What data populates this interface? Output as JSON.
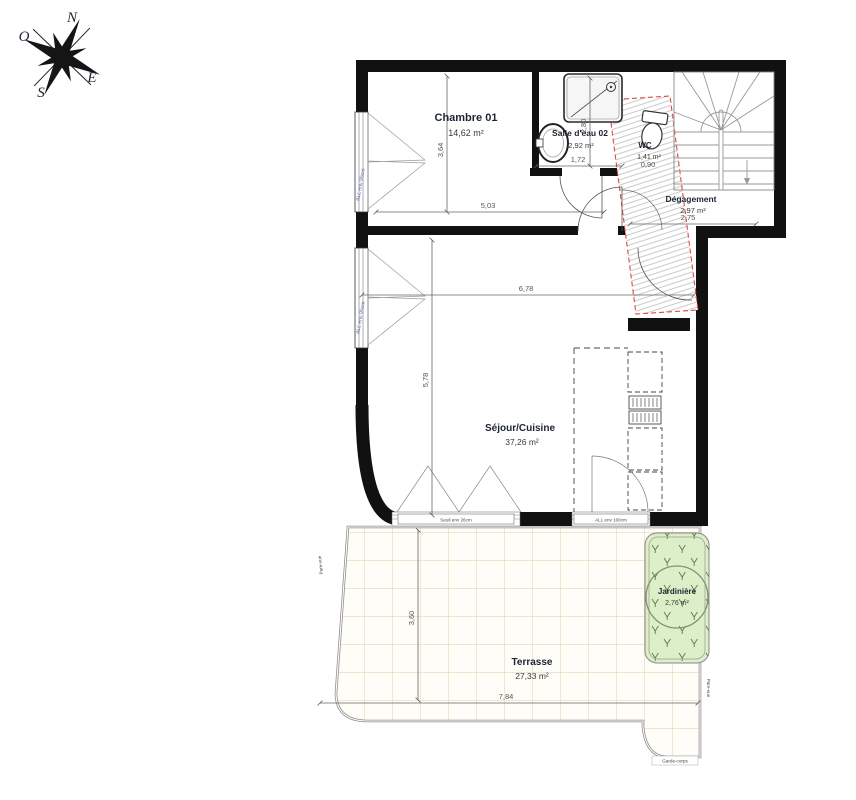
{
  "plan": {
    "compass": {
      "north": "N",
      "south": "S",
      "east": "E",
      "west": "O"
    },
    "rooms": {
      "chambre": {
        "name": "Chambre 01",
        "area": "14,62 m²"
      },
      "salle_deau": {
        "name": "Salle d'eau 02",
        "area": "2,92 m²"
      },
      "wc": {
        "name": "WC",
        "area": "1,41 m²"
      },
      "degagement": {
        "name": "Dégagement",
        "area": "2,97 m²"
      },
      "sejour": {
        "name": "Séjour/Cuisine",
        "area": "37,26 m²"
      },
      "terrasse": {
        "name": "Terrasse",
        "area": "27,33 m²"
      },
      "jardiniere": {
        "name": "Jardinière",
        "area": "2,76 m²"
      }
    },
    "dimensions": {
      "chambre_height": "3,64",
      "chambre_width": "5,03",
      "salle_deau_width": "1,72",
      "salle_deau_height": "2,80",
      "wc_width": "0,90",
      "degagement_width": "2,75",
      "sejour_width": "6,78",
      "sejour_height": "5,78",
      "terrasse_height": "3,60",
      "terrasse_width": "7,84"
    },
    "annotations": {
      "seuil": "Seuil env 26cm",
      "allege_baie": "ALL env 100cm",
      "fenetre_chambre": "ALL env 95cm",
      "fenetre_sejour": "ALL env 95cm",
      "garde_corps": "Garde-corps",
      "pare_vue": "Pare-vue"
    },
    "colors": {
      "wall": "#111111",
      "hatch_border": "#e04848",
      "jardiniere_fill": "#dcefc8",
      "tile_line": "#e9d7b8",
      "label": "#1d2433",
      "dimension": "#555555",
      "window_label": "#5a6db0"
    }
  }
}
